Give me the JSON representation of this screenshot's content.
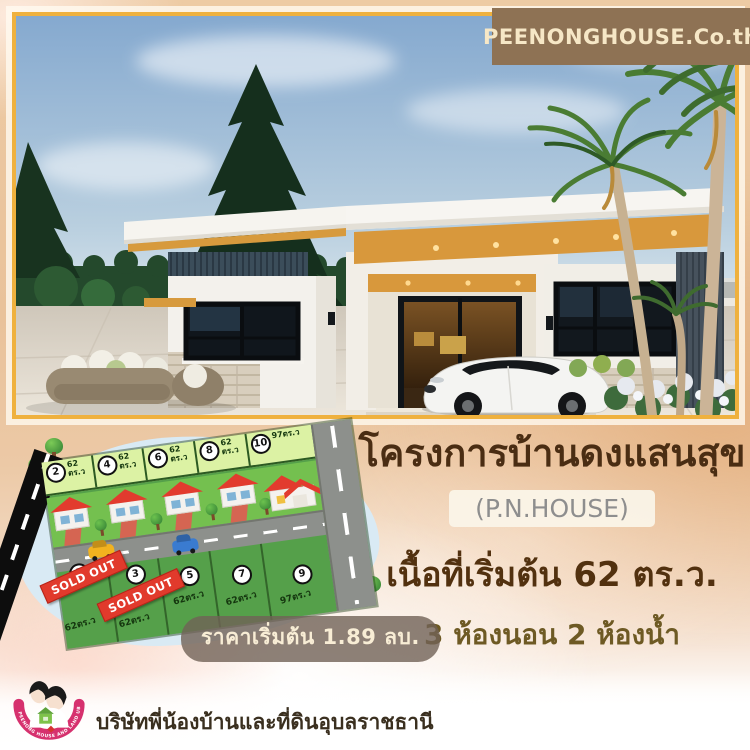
{
  "badge": {
    "label": "PEENONGHOUSE.Co.th"
  },
  "project": {
    "title": "โครงการบ้านดงแสนสุข",
    "subtitle": "(P.N.HOUSE)",
    "area_line": "เนื้อที่เริ่มต้น 62 ตร.ว.",
    "rooms_line": "3 ห้องนอน 2 ห้องน้ำ",
    "price_line": "ราคาเริ่มต้น 1.89 ลบ."
  },
  "site_plan": {
    "sold_out_label": "SOLD OUT",
    "top_plots": [
      {
        "no": "2",
        "area": "62 ตร.ว"
      },
      {
        "no": "4",
        "area": "62 ตร.ว"
      },
      {
        "no": "6",
        "area": "62 ตร.ว"
      },
      {
        "no": "8",
        "area": "62 ตร.ว"
      },
      {
        "no": "10",
        "area": "97ตร.ว"
      }
    ],
    "bottom_plots": [
      {
        "no": "1",
        "area": "62ตร.ว",
        "sold": true
      },
      {
        "no": "3",
        "area": "62ตร.ว",
        "sold": true
      },
      {
        "no": "5",
        "area": "62ตร.ว",
        "sold": false
      },
      {
        "no": "7",
        "area": "62ตร.ว",
        "sold": false
      },
      {
        "no": "9",
        "area": "97ตร.ว",
        "sold": false
      }
    ]
  },
  "footer": {
    "company": "บริษัทพี่น้องบ้านและที่ดินอุบลราชธานี",
    "logo_arc_text": "PEENONG HOUSE AND LAND UBON"
  },
  "colors": {
    "accent_gold": "#efb13e",
    "badge_brown": "#8e7254",
    "title_brown": "#4a2d13",
    "sold_red": "#e13a2c",
    "map_green": "#55a04a",
    "blob_blue": "#d9eaf4"
  }
}
